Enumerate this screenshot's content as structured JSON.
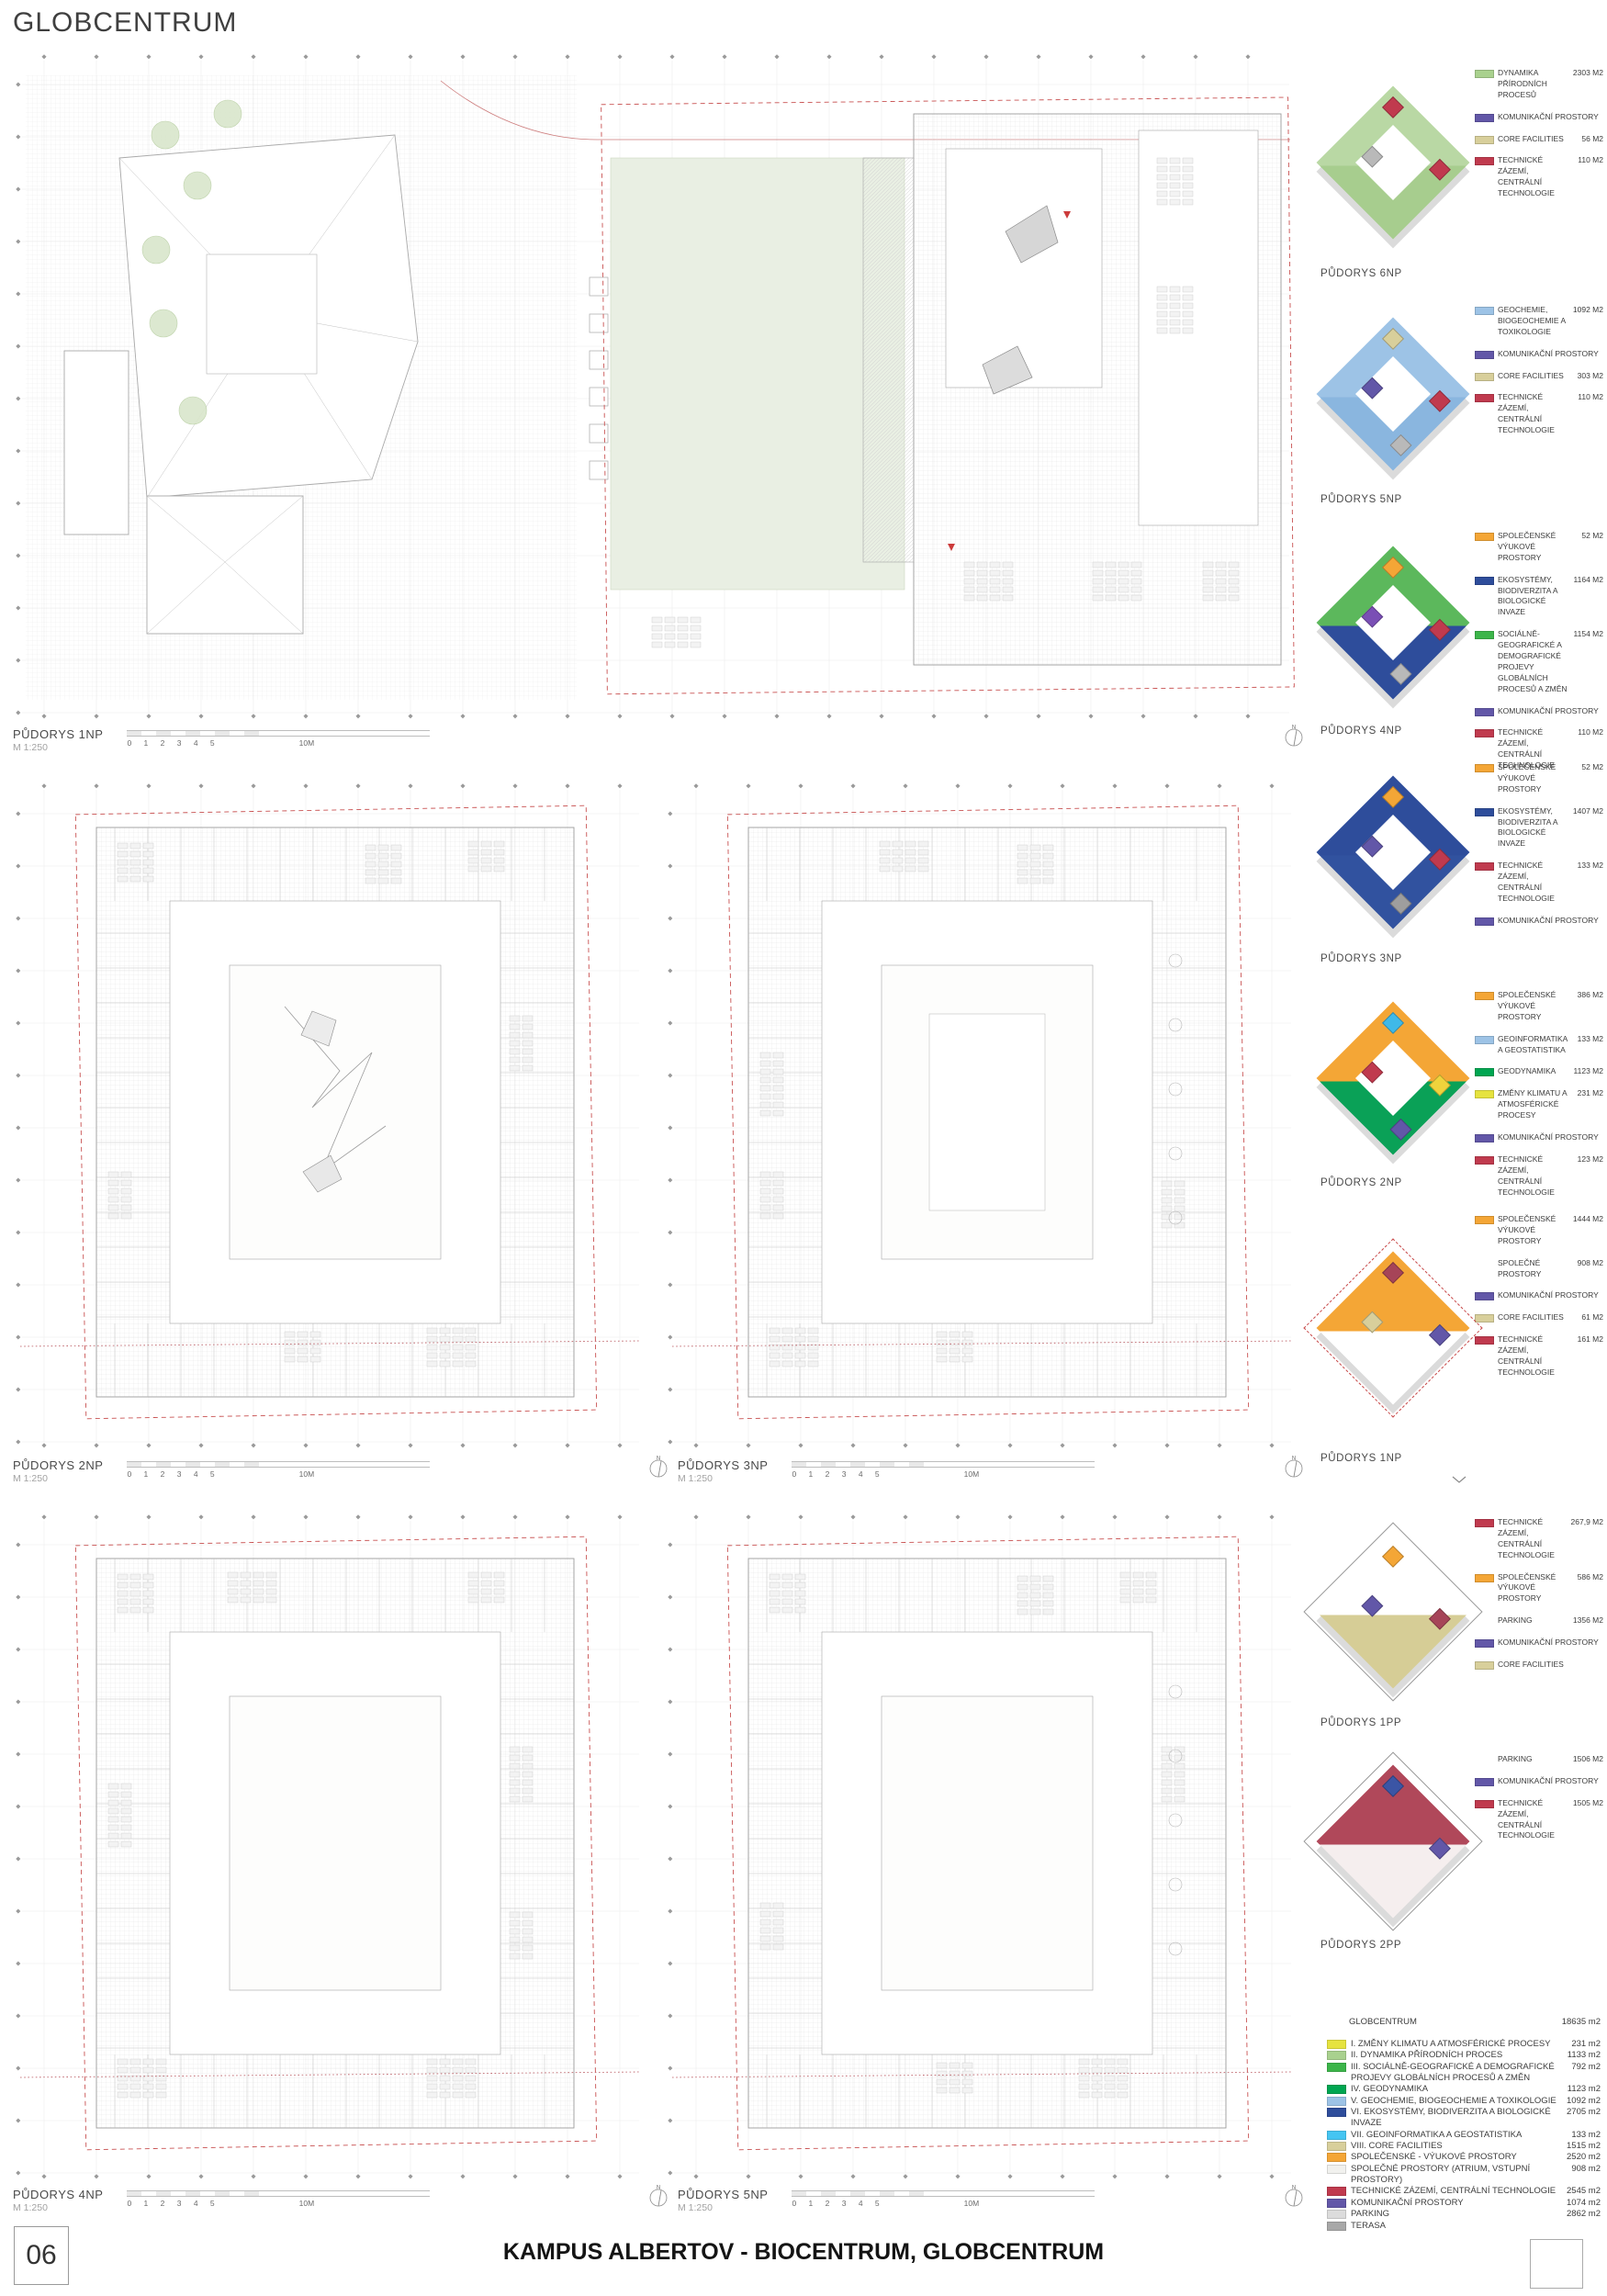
{
  "header": {
    "title": "GLOBCENTRUM"
  },
  "icons": {
    "north": "N"
  },
  "colors": {
    "yellow": "#e6e33f",
    "light_green": "#a9d18e",
    "green": "#3cb54a",
    "dark_green": "#00a651",
    "light_blue": "#9dc3e6",
    "blue": "#2e4d9b",
    "cyan": "#45c5f2",
    "tan": "#d8cf9b",
    "orange": "#f4a636",
    "light": "#f1f1ee",
    "red": "#c03a4e",
    "purple": "#6257a8",
    "gray_light": "#dcdcdc",
    "gray": "#a8a8a8"
  },
  "scalebar": {
    "scale": "M 1:250",
    "ticks_text": "0 1 2 3 4 5",
    "end": "10M"
  },
  "plans": [
    {
      "label": "PŮDORYS 1NP"
    },
    {
      "label": "PŮDORYS 2NP"
    },
    {
      "label": "PŮDORYS 3NP"
    },
    {
      "label": "PŮDORYS 4NP"
    },
    {
      "label": "PŮDORYS 5NP"
    }
  ],
  "axons": [
    {
      "id": "6np",
      "label": "PŮDORYS 6NP",
      "palette": {
        "mode": "ring",
        "primary": "#b9d8a4",
        "secondary": "#a7cd8e",
        "accents": [
          "#c03a4e",
          "#c03a4e",
          "#b9b9b9"
        ],
        "outline": "none"
      },
      "legend": [
        {
          "color": "light_green",
          "text": "DYNAMIKA PŘÍRODNÍCH PROCESŮ",
          "value": "2303 m2"
        },
        {
          "color": "purple",
          "text": "KOMUNIKAČNÍ PROSTORY",
          "value": ""
        },
        {
          "color": "tan",
          "text": "CORE FACILITIES",
          "value": "56 m2"
        },
        {
          "color": "red",
          "text": "TECHNICKÉ ZÁZEMÍ, CENTRÁLNÍ TECHNOLOGIE",
          "value": "110 m2"
        }
      ]
    },
    {
      "id": "5np",
      "label": "PŮDORYS 5NP",
      "palette": {
        "mode": "ring",
        "primary": "#9dc3e6",
        "secondary": "#8ab6df",
        "accents": [
          "#d8cf9b",
          "#c03a4e",
          "#6257a8",
          "#b9b9b9"
        ],
        "outline": "none"
      },
      "legend": [
        {
          "color": "light_blue",
          "text": "GEOCHEMIE, BIOGEOCHEMIE A TOXIKOLOGIE",
          "value": "1092 m2"
        },
        {
          "color": "purple",
          "text": "KOMUNIKAČNÍ PROSTORY",
          "value": ""
        },
        {
          "color": "tan",
          "text": "CORE FACILITIES",
          "value": "303 m2"
        },
        {
          "color": "red",
          "text": "TECHNICKÉ ZÁZEMÍ, CENTRÁLNÍ TECHNOLOGIE",
          "value": "110 m2"
        }
      ]
    },
    {
      "id": "4np",
      "label": "PŮDORYS 4NP",
      "palette": {
        "mode": "ring",
        "primary": "#5cb85c",
        "secondary": "#2e4d9b",
        "accents": [
          "#f4a636",
          "#c03a4e",
          "#7a4fb5",
          "#b9b9b9"
        ],
        "outline": "none"
      },
      "legend": [
        {
          "color": "orange",
          "text": "SPOLEČENSKÉ VÝUKOVÉ PROSTORY",
          "value": "52 m2"
        },
        {
          "color": "blue",
          "text": "EKOSYSTÉMY, BIODIVERZITA A BIOLOGICKÉ INVAZE",
          "value": "1164 m2"
        },
        {
          "color": "green",
          "text": "SOCIÁLNĚ-GEOGRAFICKÉ A DEMOGRAFICKÉ PROJEVY GLOBÁLNÍCH PROCESŮ A ZMĚN",
          "value": "1154 m2"
        },
        {
          "color": "purple",
          "text": "KOMUNIKAČNÍ PROSTORY",
          "value": ""
        },
        {
          "color": "red",
          "text": "TECHNICKÉ ZÁZEMÍ, CENTRÁLNÍ TECHNOLOGIE",
          "value": "110 m2"
        }
      ]
    },
    {
      "id": "3np",
      "label": "PŮDORYS 3NP",
      "palette": {
        "mode": "ring",
        "primary": "#2e4d9b",
        "secondary": "#31529f",
        "accents": [
          "#f4a636",
          "#c03a4e",
          "#6257a8",
          "#9e9e9e"
        ],
        "outline": "none"
      },
      "legend": [
        {
          "color": "orange",
          "text": "SPOLEČENSKÉ VÝUKOVÉ PROSTORY",
          "value": "52 m2"
        },
        {
          "color": "blue",
          "text": "EKOSYSTÉMY, BIODIVERZITA A BIOLOGICKÉ INVAZE",
          "value": "1407 m2"
        },
        {
          "color": "red",
          "text": "TECHNICKÉ ZÁZEMÍ, CENTRÁLNÍ TECHNOLOGIE",
          "value": "133 m2"
        },
        {
          "color": "purple",
          "text": "KOMUNIKAČNÍ PROSTORY",
          "value": ""
        }
      ]
    },
    {
      "id": "2np",
      "label": "PŮDORYS 2NP",
      "palette": {
        "mode": "ring",
        "primary": "#f4a636",
        "secondary": "#0aa157",
        "accents": [
          "#3fb9e8",
          "#f0d33c",
          "#c03a4e",
          "#6257a8"
        ],
        "outline": "none"
      },
      "legend": [
        {
          "color": "orange",
          "text": "SPOLEČENSKÉ VÝUKOVÉ PROSTORY",
          "value": "386 m2"
        },
        {
          "color": "light_blue",
          "text": "GEOINFORMATIKA A GEOSTATISTIKA",
          "value": "133 m2"
        },
        {
          "color": "dark_green",
          "text": "GEODYNAMIKA",
          "value": "1123 m2"
        },
        {
          "color": "yellow",
          "text": "ZMĚNY KLIMATU A ATMOSFÉRICKÉ PROCESY",
          "value": "231 m2"
        },
        {
          "color": "purple",
          "text": "KOMUNIKAČNÍ PROSTORY",
          "value": ""
        },
        {
          "color": "red",
          "text": "TECHNICKÉ ZÁZEMÍ, CENTRÁLNÍ TECHNOLOGIE",
          "value": "123 m2"
        }
      ]
    },
    {
      "id": "1np",
      "label": "PŮDORYS 1NP",
      "palette": {
        "mode": "solid",
        "primary": "#f4a636",
        "secondary": "#ffffff",
        "accents": [
          "#a64458",
          "#6257a8",
          "#d8cf9b"
        ],
        "outline": "red"
      },
      "legend": [
        {
          "color": "orange",
          "text": "SPOLEČENSKÉ VÝUKOVÉ PROSTORY",
          "value": "1444 m2"
        },
        {
          "color": null,
          "text": "SPOLEČNÉ PROSTORY",
          "value": "908 m2"
        },
        {
          "color": "purple",
          "text": "KOMUNIKAČNÍ PROSTORY",
          "value": ""
        },
        {
          "color": "tan",
          "text": "CORE FACILITIES",
          "value": "61 m2"
        },
        {
          "color": "red",
          "text": "TECHNICKÉ ZÁZEMÍ, CENTRÁLNÍ TECHNOLOGIE",
          "value": "161 m2"
        }
      ]
    },
    {
      "id": "1pp",
      "label": "PŮDORYS 1PP",
      "palette": {
        "mode": "solid",
        "primary": "#ffffff",
        "secondary": "#d6cd96",
        "accents": [
          "#f4a636",
          "#a64458",
          "#6257a8"
        ],
        "outline": "gray"
      },
      "legend": [
        {
          "color": "red",
          "text": "TECHNICKÉ ZÁZEMÍ, CENTRÁLNÍ TECHNOLOGIE",
          "value": "267,9 m2"
        },
        {
          "color": "orange",
          "text": "SPOLEČENSKÉ VÝUKOVÉ PROSTORY",
          "value": "586 m2"
        },
        {
          "color": null,
          "text": "PARKING",
          "value": "1356 m2"
        },
        {
          "color": "purple",
          "text": "KOMUNIKAČNÍ PROSTORY",
          "value": ""
        },
        {
          "color": "tan",
          "text": "CORE FACILITIES",
          "value": ""
        }
      ]
    },
    {
      "id": "2pp",
      "label": "PŮDORYS 2PP",
      "palette": {
        "mode": "solid",
        "primary": "#b0485a",
        "secondary": "#f5eeee",
        "accents": [
          "#3b55a5",
          "#6257a8"
        ],
        "outline": "gray"
      },
      "legend": [
        {
          "color": null,
          "text": "PARKING",
          "value": "1506 m2"
        },
        {
          "color": "purple",
          "text": "KOMUNIKAČNÍ PROSTORY",
          "value": ""
        },
        {
          "color": "red",
          "text": "TECHNICKÉ ZÁZEMÍ, CENTRÁLNÍ TECHNOLOGIE",
          "value": "1505 m2"
        }
      ]
    }
  ],
  "summary": {
    "title": "GLOBCENTRUM",
    "total": "18635 m2",
    "rows": [
      {
        "color": "yellow",
        "text": "I. ZMĚNY KLIMATU A ATMOSFÉRICKÉ PROCESY",
        "value": "231 m2"
      },
      {
        "color": "light_green",
        "text": "II. DYNAMIKA PŘÍRODNÍCH PROCES",
        "value": "1133 m2"
      },
      {
        "color": "green",
        "text": "III. SOCIÁLNĚ-GEOGRAFICKÉ A DEMOGRAFICKÉ PROJEVY GLOBÁLNÍCH PROCESŮ A ZMĚN",
        "value": "792 m2"
      },
      {
        "color": "dark_green",
        "text": "IV. GEODYNAMIKA",
        "value": "1123 m2"
      },
      {
        "color": "light_blue",
        "text": "V. GEOCHEMIE, BIOGEOCHEMIE A TOXIKOLOGIE",
        "value": "1092 m2"
      },
      {
        "color": "blue",
        "text": "VI. EKOSYSTÉMY, BIODIVERZITA A BIOLOGICKÉ INVAZE",
        "value": "2705 m2"
      },
      {
        "color": "cyan",
        "text": "VII. GEOINFORMATIKA A GEOSTATISTIKA",
        "value": "133 m2"
      },
      {
        "color": "tan",
        "text": "VIII. CORE FACILITIES",
        "value": "1515 m2"
      },
      {
        "color": "orange",
        "text": "SPOLEČENSKÉ - VÝUKOVÉ PROSTORY",
        "value": "2520 m2"
      },
      {
        "color": "light",
        "text": "SPOLEČNÉ PROSTORY (ATRIUM, VSTUPNÍ PROSTORY)",
        "value": "908 m2"
      },
      {
        "color": "red",
        "text": "TECHNICKÉ ZÁZEMÍ, CENTRÁLNÍ TECHNOLOGIE",
        "value": "2545 m2"
      },
      {
        "color": "purple",
        "text": "KOMUNIKAČNÍ PROSTORY",
        "value": "1074 m2"
      },
      {
        "color": "gray_light",
        "text": "PARKING",
        "value": "2862 m2"
      },
      {
        "color": "gray",
        "text": "TERASA",
        "value": ""
      }
    ]
  },
  "footer": {
    "page_number": "06",
    "title": "KAMPUS ALBERTOV - BIOCENTRUM, GLOBCENTRUM"
  }
}
